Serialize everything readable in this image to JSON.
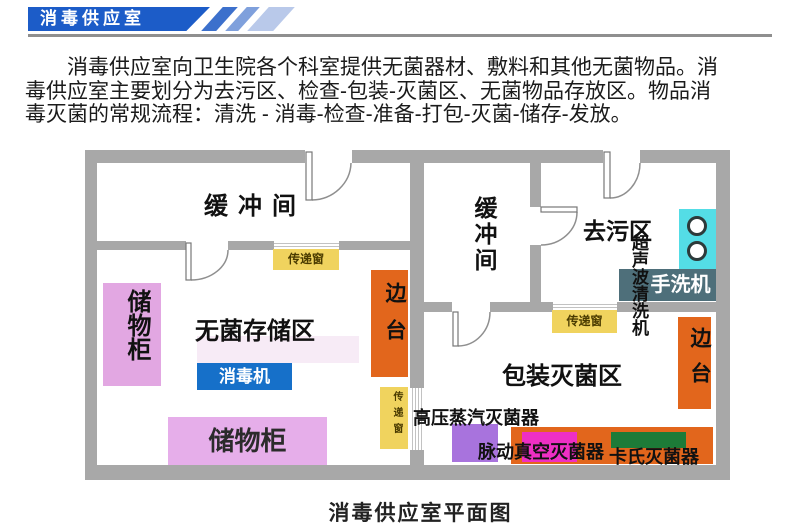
{
  "header": {
    "banner_label": "消毒供应室"
  },
  "intro": {
    "lines": [
      "消毒供应室向卫生院各个科室提供无菌器材、敷料和其他无菌物品。消",
      "毒供应室主要划分为去污区、检查-包装-灭菌区、无菌物品存放区。物品消",
      "毒灭菌的常规流程：清洗 - 消毒-检查-准备-打包-灭菌-储存-发放。"
    ]
  },
  "plan": {
    "caption": "消毒供应室平面图",
    "rooms": {
      "buffer_left": "缓冲间",
      "buffer_right": "缓冲间",
      "sterile_storage": "无菌存储区",
      "decontamination": "去污区",
      "packaging": "包装灭菌区"
    },
    "items": {
      "cabinet_left": "储物柜",
      "cabinet_bottom": "储物柜",
      "disinfector": "消毒机",
      "side_table_left": "边台",
      "side_table_right": "边台",
      "transfer_window_top": "传递窗",
      "transfer_window_mid": "传递窗",
      "transfer_window_right": "传递窗",
      "ultrasonic_cleaner": "超声波清洗机",
      "hand_washer": "手洗机",
      "autoclave": "高压蒸汽灭菌器",
      "pulse_vacuum_sterilizer": "脉动真空灭菌器",
      "cassette_sterilizer": "卡氏灭菌器"
    }
  },
  "colors": {
    "banner_blue": "#1c5cc8",
    "stripe_1": "#3c70cc",
    "stripe_2": "#7fa0dc",
    "stripe_3": "#b9c9ea",
    "wall_gray": "#a8a8a8",
    "cabinet_pink": "#e2a7e2",
    "cabinet_pink_light": "#e6aeea",
    "faint_pink": "#f7ebf6",
    "disinfector_blue": "#1670c9",
    "bench_orange": "#e2661c",
    "window_yellow": "#f0d35e",
    "ultrasonic_cyan": "#54dde6",
    "washer_slate": "#4e6f7a",
    "autoclave_purple": "#a873dd",
    "pulse_magenta": "#ee2fc4",
    "cassette_green": "#1d7b38"
  }
}
